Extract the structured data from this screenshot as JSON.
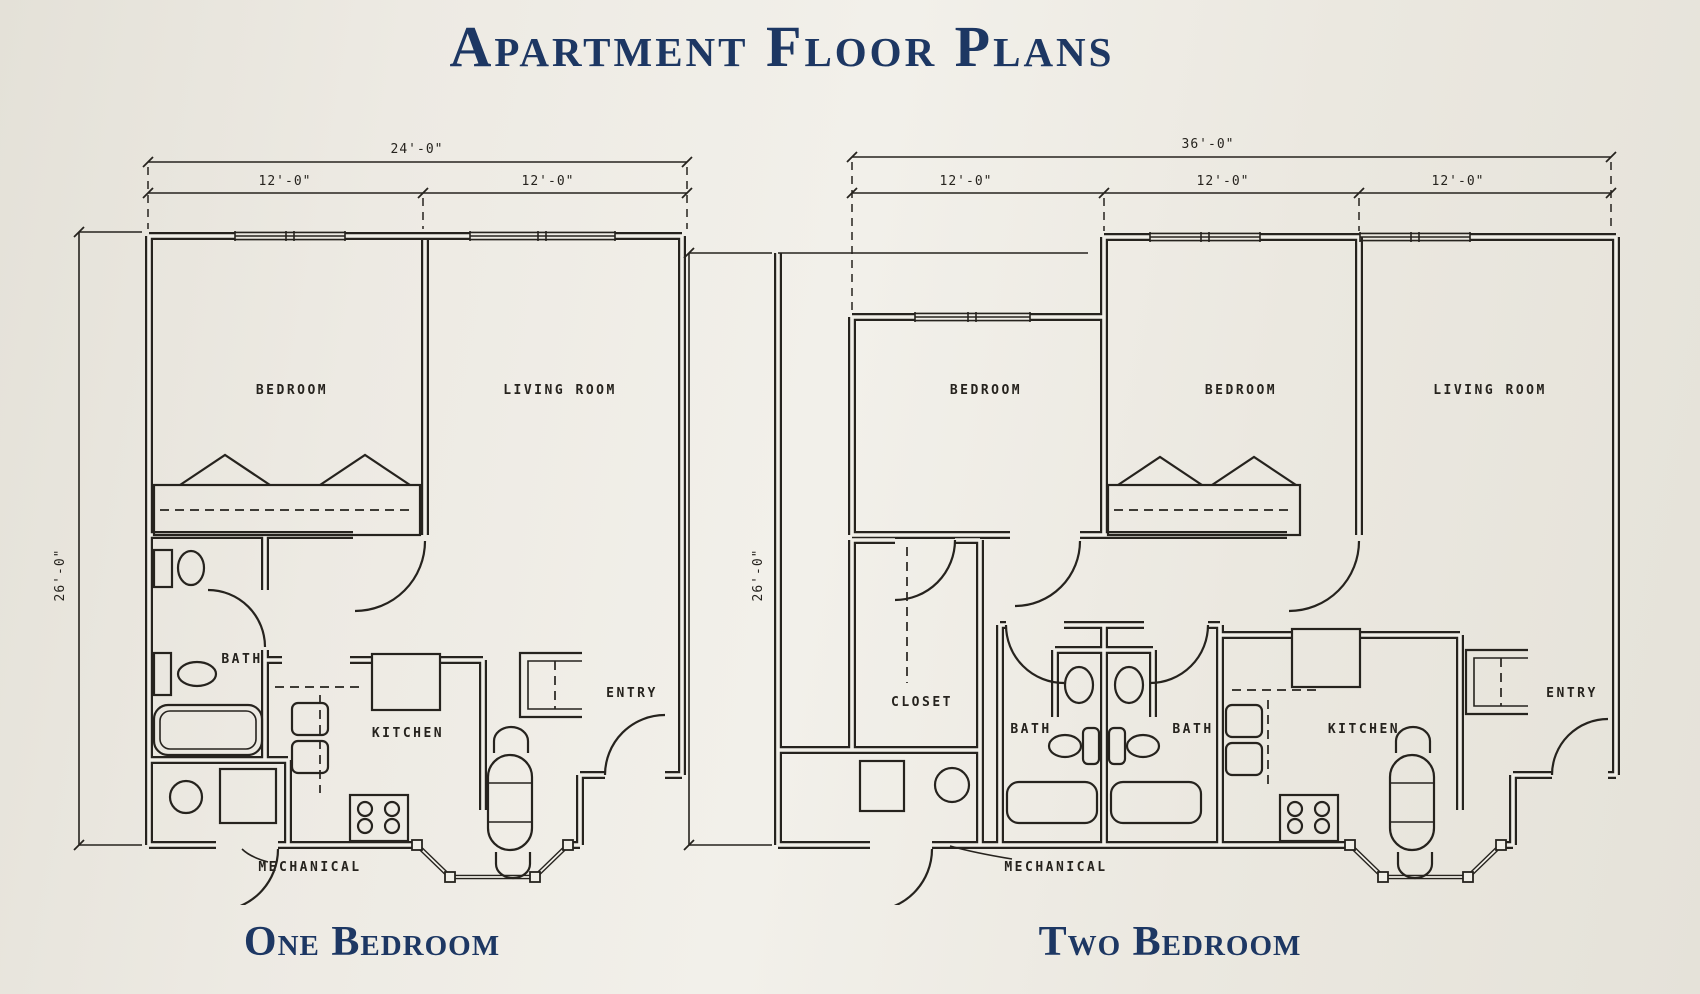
{
  "page": {
    "title": "Apartment Floor Plans",
    "title_color": "#1d3763",
    "ink_color": "#26231e",
    "background_color": "#edeae3"
  },
  "plans": [
    {
      "caption": "One Bedroom",
      "dims": {
        "overall": "24'-0\"",
        "seg1": "12'-0\"",
        "seg2": "12'-0\"",
        "height": "26'-0\""
      },
      "labels": {
        "bedroom": "BEDROOM",
        "living_room": "LIVING ROOM",
        "bath": "BATH",
        "kitchen": "KITCHEN",
        "entry": "ENTRY",
        "mechanical": "MECHANICAL"
      }
    },
    {
      "caption": "Two Bedroom",
      "dims": {
        "overall": "36'-0\"",
        "seg1": "12'-0\"",
        "seg2": "12'-0\"",
        "seg3": "12'-0\"",
        "height": "26'-0\""
      },
      "labels": {
        "bedroom1": "BEDROOM",
        "bedroom2": "BEDROOM",
        "living_room": "LIVING ROOM",
        "closet": "CLOSET",
        "bath1": "BATH",
        "bath2": "BATH",
        "kitchen": "KITCHEN",
        "entry": "ENTRY",
        "mechanical": "MECHANICAL"
      }
    }
  ]
}
